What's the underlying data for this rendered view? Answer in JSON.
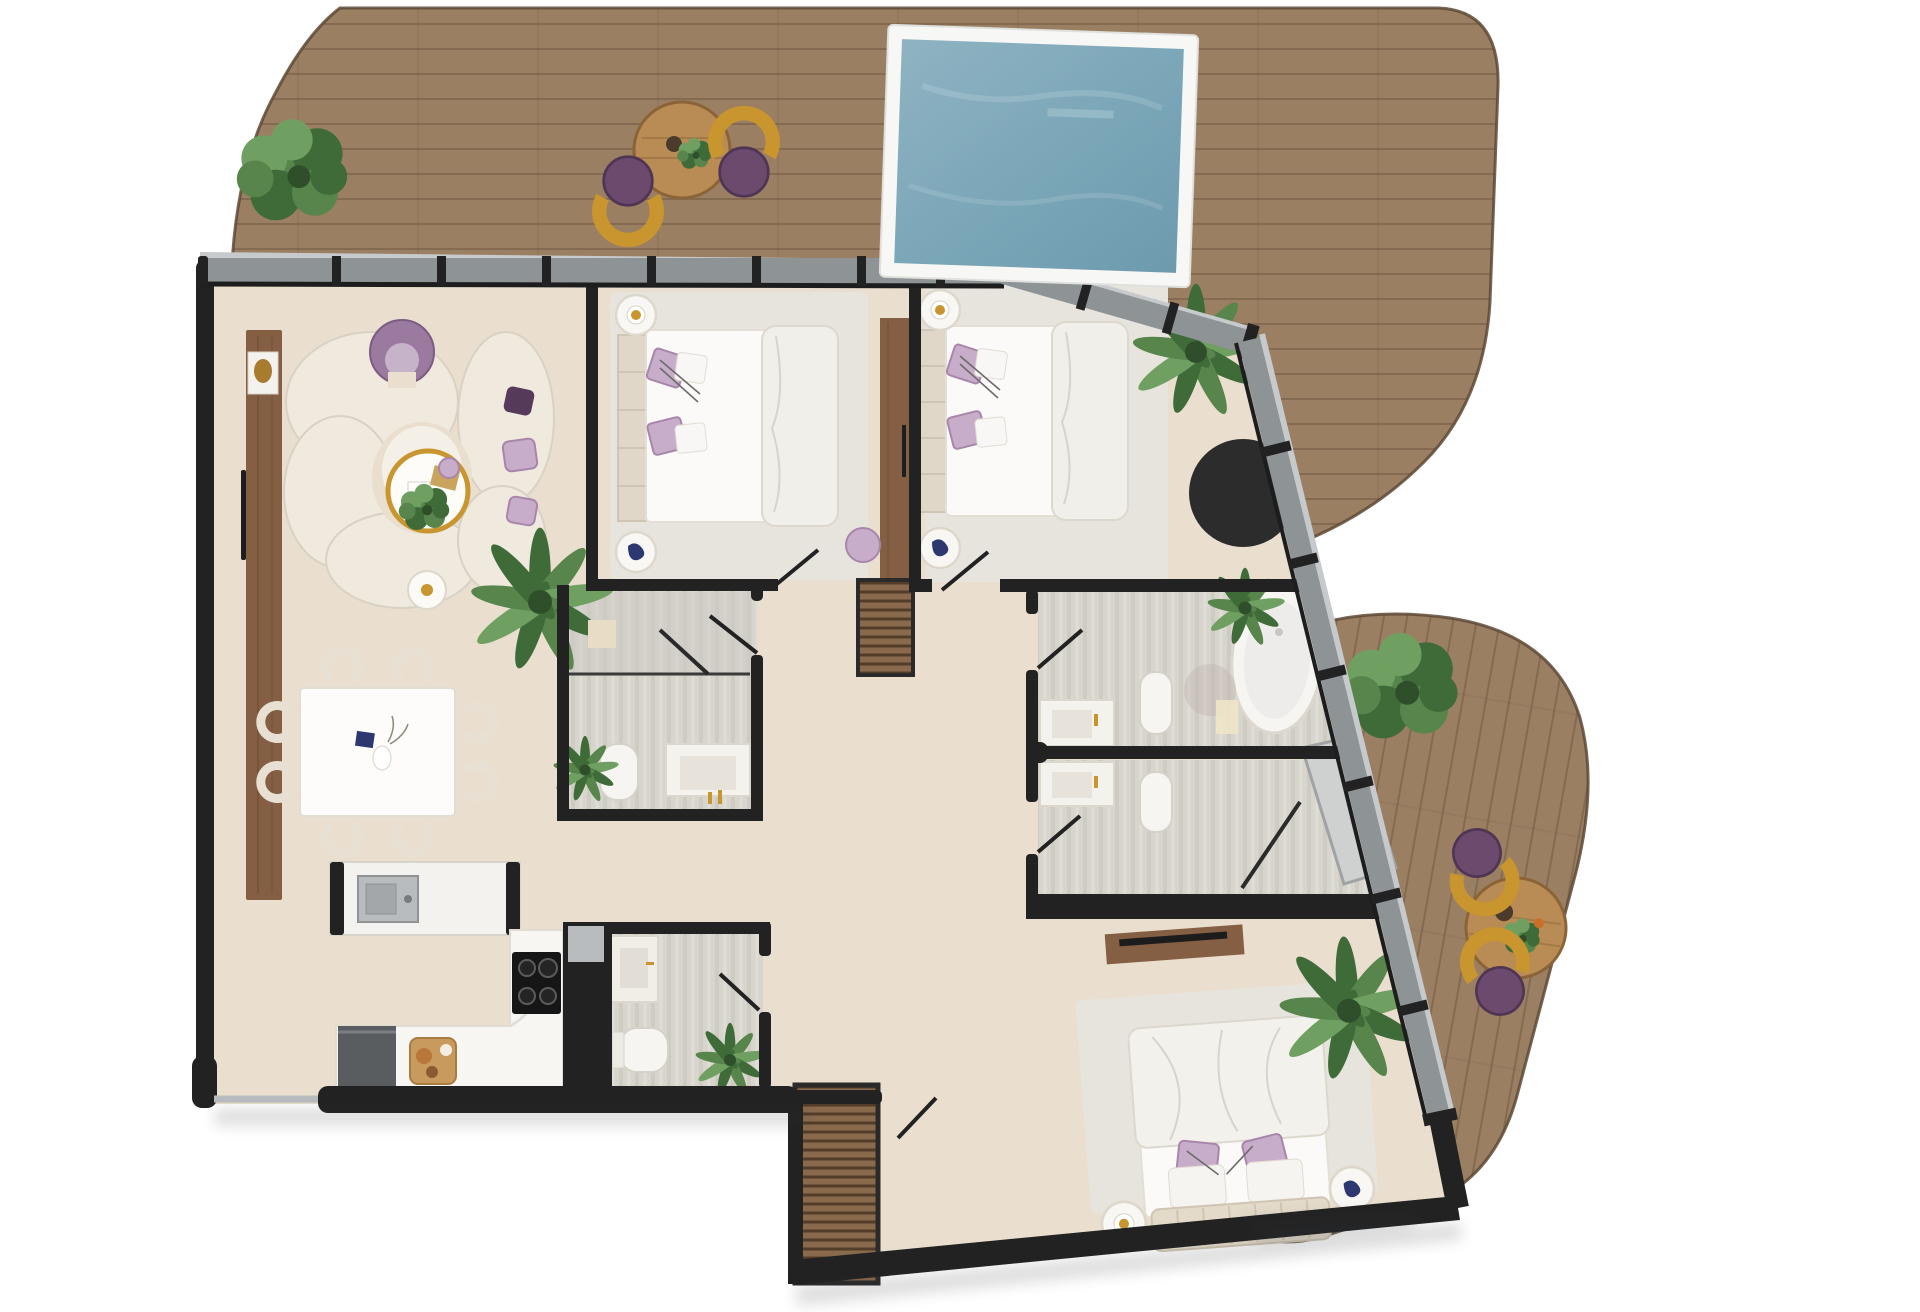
{
  "scene": {
    "kind": "apartment-floor-plan",
    "style": "photoreal top-down render, no labels",
    "areas": [
      {
        "id": "top-terrace",
        "surface": "wood-deck",
        "items": [
          "swimming-pool",
          "outdoor-table",
          "outdoor-stool",
          "outdoor-stool",
          "shrub",
          "shrub",
          "palm-plant"
        ]
      },
      {
        "id": "side-terrace",
        "surface": "wood-deck",
        "items": [
          "outdoor-table",
          "outdoor-stool",
          "outdoor-stool",
          "shrub"
        ]
      },
      {
        "id": "living-room",
        "items": [
          "sideboard-console",
          "curved-sofa",
          "accent-armchair",
          "coffee-table",
          "pouf",
          "side-table",
          "palm-plant"
        ]
      },
      {
        "id": "dining-area",
        "items": [
          "dining-table",
          "dining-chair",
          "dining-chair",
          "dining-chair",
          "dining-chair",
          "dining-chair",
          "dining-chair",
          "dining-chair",
          "dining-chair"
        ]
      },
      {
        "id": "kitchen",
        "items": [
          "island-with-sink",
          "l-counter",
          "cooktop",
          "base-cabinet",
          "cutting-board"
        ]
      },
      {
        "id": "bedroom-1",
        "items": [
          "double-bed",
          "nightstand",
          "nightstand",
          "wardrobe",
          "pouf",
          "rug"
        ]
      },
      {
        "id": "bedroom-2",
        "items": [
          "double-bed",
          "nightstand",
          "nightstand",
          "palm-plant",
          "round-rug",
          "rug"
        ]
      },
      {
        "id": "guest-bathroom",
        "items": [
          "shower",
          "toilet",
          "vanity",
          "plant"
        ]
      },
      {
        "id": "powder-room",
        "items": [
          "vanity",
          "toilet",
          "plant"
        ]
      },
      {
        "id": "master-bathroom",
        "items": [
          "bathtub",
          "toilet",
          "vanity",
          "plant"
        ]
      },
      {
        "id": "shower-room",
        "items": [
          "shower",
          "toilet",
          "vanity"
        ]
      },
      {
        "id": "hallway",
        "items": [
          "slatted-dresser",
          "slatted-wardrobe"
        ]
      },
      {
        "id": "master-bedroom",
        "items": [
          "double-bed",
          "nightstand",
          "nightstand",
          "tv-console",
          "palm-plant",
          "rug"
        ]
      }
    ],
    "counts": {
      "outdoor_stools": 4,
      "dining_chairs": 8,
      "beds": 3,
      "toilets": 4,
      "plants": 9
    }
  },
  "palette": {
    "deck": "#9b7f63",
    "deck-line": "#6e563f",
    "deck-edge": "#5e4936",
    "floor": "#eadfce",
    "wall": "#222222",
    "band": "#8e9396",
    "band-light": "#c7cacc",
    "bath-floor": "#d8d5cd",
    "rug": "#e7e4de",
    "cream": "#efe9de",
    "cream-line": "#d9d2c4",
    "cream-line2": "#e8e1d3",
    "white-furn": "#f8f7f4",
    "wood-furn": "#855f43",
    "wood-slat": "#8a6a4c",
    "table-wood": "#b98c55",
    "steel": "#b9bcbe",
    "gold": "#c8952f",
    "navy": "#2e3870",
    "purple": "#6b4a6e",
    "purple-dark": "#553a59",
    "lilac": "#c8adca",
    "lilac-edge": "#a886ab",
    "green-dark": "#3f6b39",
    "green-mid": "#57854b",
    "green-light": "#6fa061",
    "pool-frame": "#f7f7f5",
    "water-1": "#8fb3c2",
    "water-2": "#6e9aae",
    "gray-obj": "#5a5d5f",
    "shadow": "#9aa0a4"
  }
}
